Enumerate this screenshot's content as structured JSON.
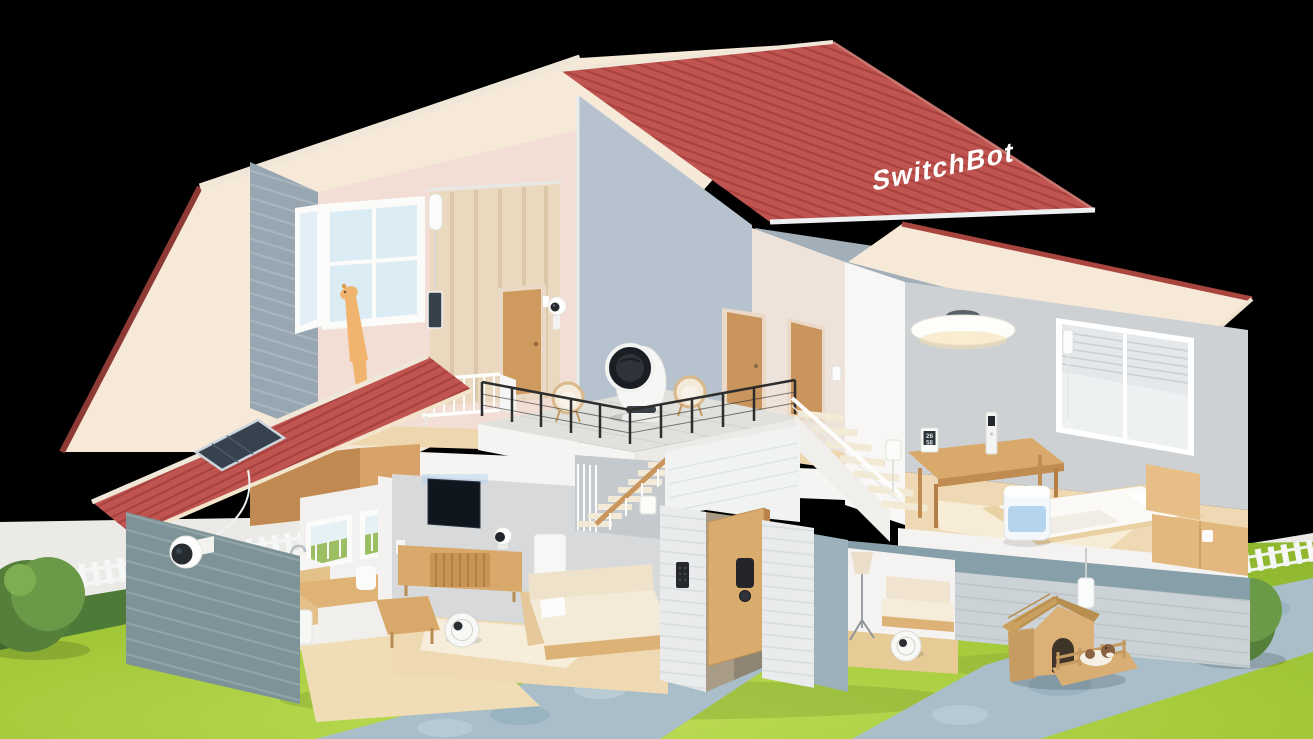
{
  "scene": {
    "description": "Isometric 3D cutaway render of a two-story SwitchBot smart home on a lawn with stone paths, picket fences, bushes and a dog house, against a black background.",
    "brand": {
      "roof_text": "SwitchBot",
      "text_color": "#ffffff"
    },
    "meter": {
      "temperature": "26",
      "humidity": "58"
    },
    "palette": {
      "background": "#000000",
      "roof_red": "#c05450",
      "roof_tile_line": "#a8423f",
      "roof_trim": "#8d3a36",
      "roof_underside": "#f6e9d8",
      "wall_pink": "#f2ded4",
      "wall_gray": "#cdd1d4",
      "accent_wall": "#b6c2cd",
      "brick_blue_gray": "#97a6b1",
      "brick_green_gray": "#7e9397",
      "brick_white": "#e9ebec",
      "wood": "#d9a96b",
      "wood_light": "#eed7ae",
      "lawn": "#a4c839",
      "lawn_dark": "#4e7a38",
      "path_stone": "#a9bec9",
      "fence_white": "#f6f8f8",
      "humidifier_blue": "#aed0ec",
      "device_black": "#232528",
      "device_white": "#f8f8f6"
    },
    "rooms": [
      {
        "name": "nursery",
        "floor": 2
      },
      {
        "name": "upstairs-hallway",
        "floor": 2
      },
      {
        "name": "balcony-terrace",
        "floor": 2
      },
      {
        "name": "bedroom",
        "floor": 2
      },
      {
        "name": "living-room",
        "floor": 1
      },
      {
        "name": "kitchen",
        "floor": 1
      },
      {
        "name": "entryway",
        "floor": 1
      },
      {
        "name": "den",
        "floor": 1
      },
      {
        "name": "yard",
        "floor": 0
      }
    ],
    "devices": [
      {
        "name": "curtain-bot",
        "location": "nursery curtain rail"
      },
      {
        "name": "curtain-bot-solar-charger",
        "location": "nursery curtain"
      },
      {
        "name": "indoor-camera",
        "location": "nursery wall beside door"
      },
      {
        "name": "contact-sensor",
        "location": "nursery door frame"
      },
      {
        "name": "air-circulator-fan",
        "location": "balcony terrace"
      },
      {
        "name": "smart-ceiling-light",
        "location": "bedroom ceiling"
      },
      {
        "name": "blind-tilt",
        "location": "bedroom window blinds"
      },
      {
        "name": "meter-hub",
        "location": "bedroom table"
      },
      {
        "name": "remote-control",
        "location": "bedroom table"
      },
      {
        "name": "smart-humidifier",
        "location": "bedroom floor beside bed"
      },
      {
        "name": "bot-button-presser",
        "location": "bedroom side cabinet"
      },
      {
        "name": "hub-mini",
        "location": "bedroom wall by stairs"
      },
      {
        "name": "wall-switch-bot",
        "location": "hallway beside door"
      },
      {
        "name": "wall-hub",
        "location": "living room wall under stairs"
      },
      {
        "name": "smart-lock",
        "location": "front door"
      },
      {
        "name": "keypad",
        "location": "entry wall"
      },
      {
        "name": "pan-tilt-camera",
        "location": "tv console"
      },
      {
        "name": "robot-vacuum",
        "location": "living room floor"
      },
      {
        "name": "self-empty-dock",
        "location": "living room under stairs"
      },
      {
        "name": "robot-vacuum-2",
        "location": "den floor"
      },
      {
        "name": "outdoor-camera",
        "location": "kitchen exterior wall"
      },
      {
        "name": "solar-panel",
        "location": "kitchen roof"
      },
      {
        "name": "kitchen-appliance",
        "location": "kitchen floor"
      },
      {
        "name": "wall-outlet-plug",
        "location": "living room wall"
      },
      {
        "name": "outdoor-hub",
        "location": "exterior wall above dog house"
      }
    ],
    "furniture": [
      "open-window",
      "curtain",
      "giraffe-toy",
      "baby-crib",
      "wooden-doors",
      "wicker-chairs",
      "balcony-railing",
      "television",
      "tv-console",
      "main-staircase",
      "bedroom-staircase",
      "sofa",
      "coffee-table",
      "kitchen-sink",
      "kitchen-cabinet",
      "island-table",
      "dining-chair",
      "bed",
      "headboard",
      "side-cabinet",
      "bedroom-table",
      "floor-lamp",
      "den-sofa"
    ],
    "outdoor_elements": [
      "lawn",
      "dark-hedge-row",
      "picket-fence-left",
      "picket-fence-right",
      "stone-path-entry",
      "stone-path-right",
      "bush-left",
      "bush-right",
      "dog-house",
      "dog",
      "kennel-fence"
    ]
  }
}
